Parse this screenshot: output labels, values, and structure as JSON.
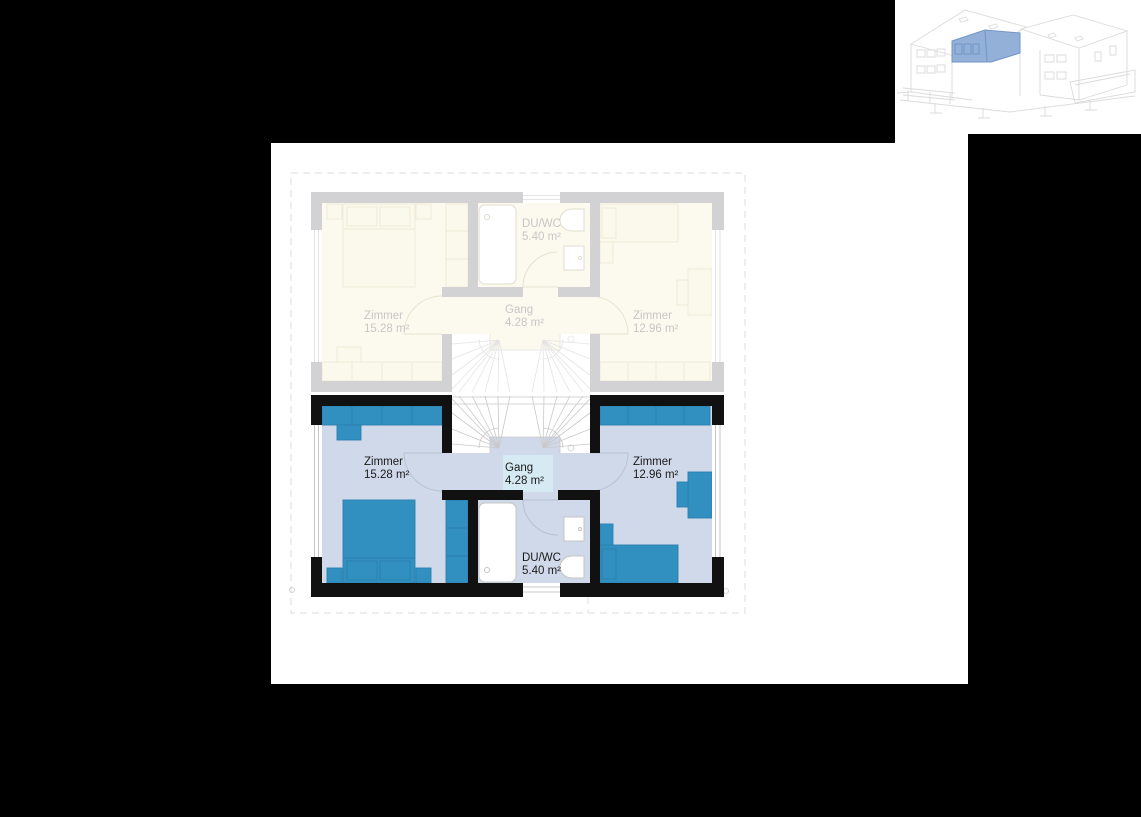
{
  "colors": {
    "background": "#000000",
    "panel": "#FFFFFF",
    "wall_active": "#111111",
    "wall_faded": "#D2D2D4",
    "room_fill": "#D0D9E9",
    "room_faded": "#FCFAEE",
    "furniture": "#3290C1",
    "gang_highlight": "#D6EAF3",
    "highlight_unit_blue": "#93B1D8",
    "sketch_line": "#DBDBDB",
    "label_active": "#1A1A1A",
    "label_faded": "#C6C6C6"
  },
  "floor_plan": {
    "active_unit": {
      "rooms": [
        {
          "name": "Zimmer",
          "area": "15.28 m²"
        },
        {
          "name": "Gang",
          "area": "4.28 m²"
        },
        {
          "name": "Zimmer",
          "area": "12.96 m²"
        },
        {
          "name": "DU/WC",
          "area": "5.40 m²"
        }
      ]
    },
    "adjacent_unit": {
      "rooms": [
        {
          "name": "Zimmer",
          "area": "15.28 m²"
        },
        {
          "name": "Gang",
          "area": "4.28 m²"
        },
        {
          "name": "Zimmer",
          "area": "12.96 m²"
        },
        {
          "name": "DU/WC",
          "area": "5.40 m²"
        }
      ]
    }
  }
}
